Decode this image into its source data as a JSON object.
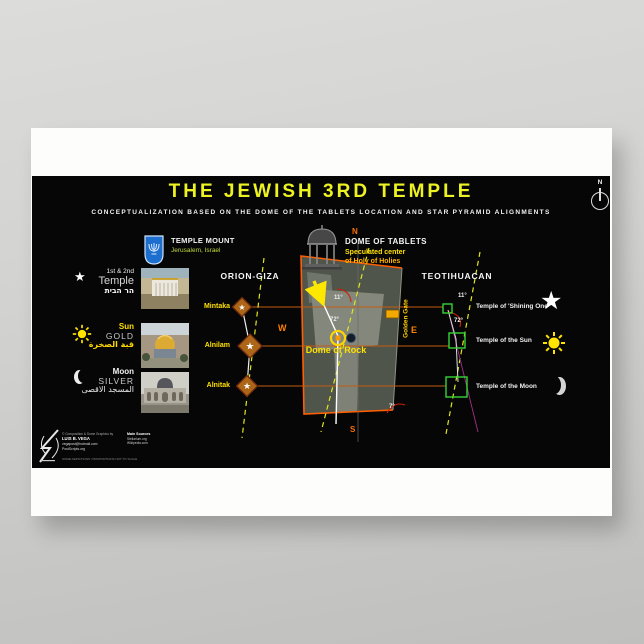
{
  "poster": {
    "title": "THE JEWISH 3RD TEMPLE",
    "subtitle": "CONCEPTUALIZATION BASED ON THE DOME OF THE TABLETS LOCATION AND STAR PYRAMID ALIGNMENTS",
    "compass_n": "N"
  },
  "temple_mount": {
    "title": "TEMPLE MOUNT",
    "subtitle": "Jerusalem, Israel",
    "emblem": "israel-state-emblem"
  },
  "legend": {
    "rows": [
      {
        "icon": "star-icon",
        "line1": "1st & 2nd",
        "line2": "Temple",
        "line3": "הר הבית",
        "photo": "model-of-1st-and-2nd-temple"
      },
      {
        "icon": "sun-icon",
        "line1": "Sun",
        "line2": "GOLD",
        "line3": "قبة الصخرة",
        "photo": "dome-of-the-rock-photo"
      },
      {
        "icon": "moon-icon",
        "line1": "Moon",
        "line2": "SILVER",
        "line3": "المسجد الاقصى",
        "photo": "al-aqsa-mosque-photo"
      }
    ]
  },
  "orion": {
    "title": "ORION-GIZA",
    "stars": [
      "Mintaka",
      "Alnilam",
      "Alnitak"
    ]
  },
  "map": {
    "title": "DOME OF TABLETS",
    "subtitle1": "Speculated center",
    "subtitle2": "of Holy of Holies",
    "dome_of_rock": "Dome of Rock",
    "golden_gate": "Golden Gate",
    "angle_11": "11°",
    "angle_72": "72°",
    "angle_7": "7°",
    "north": "N",
    "south": "S",
    "east": "E",
    "west": "W"
  },
  "teotihuacan": {
    "title": "TEOTIHUACAN",
    "angle_11": "11°",
    "angle_72": "72°",
    "temples": [
      "Temple of 'Shining One'",
      "Temple of the Sun",
      "Temple of the Moon"
    ]
  },
  "credits": {
    "byline": "© Composition & Some Graphics by",
    "author": "LUIS B. VEGA",
    "email": "vegapost@hotmail.com",
    "site": "PostScripts.org",
    "note": "SOME DEPICTIONS / PROPORTIONS NOT TO SCALE",
    "sources_title": "Main Sources",
    "sources": [
      "Stellarium.org",
      "Wikipedia.com"
    ]
  },
  "icons": {
    "star": "★"
  },
  "colors": {
    "title_yellow": "#edf223",
    "label_yellow": "#ffe000",
    "accent_orange": "#ff6a00",
    "alignment_green": "#35d435",
    "magenta_line": "#a2308a",
    "panel_black": "#060606"
  }
}
